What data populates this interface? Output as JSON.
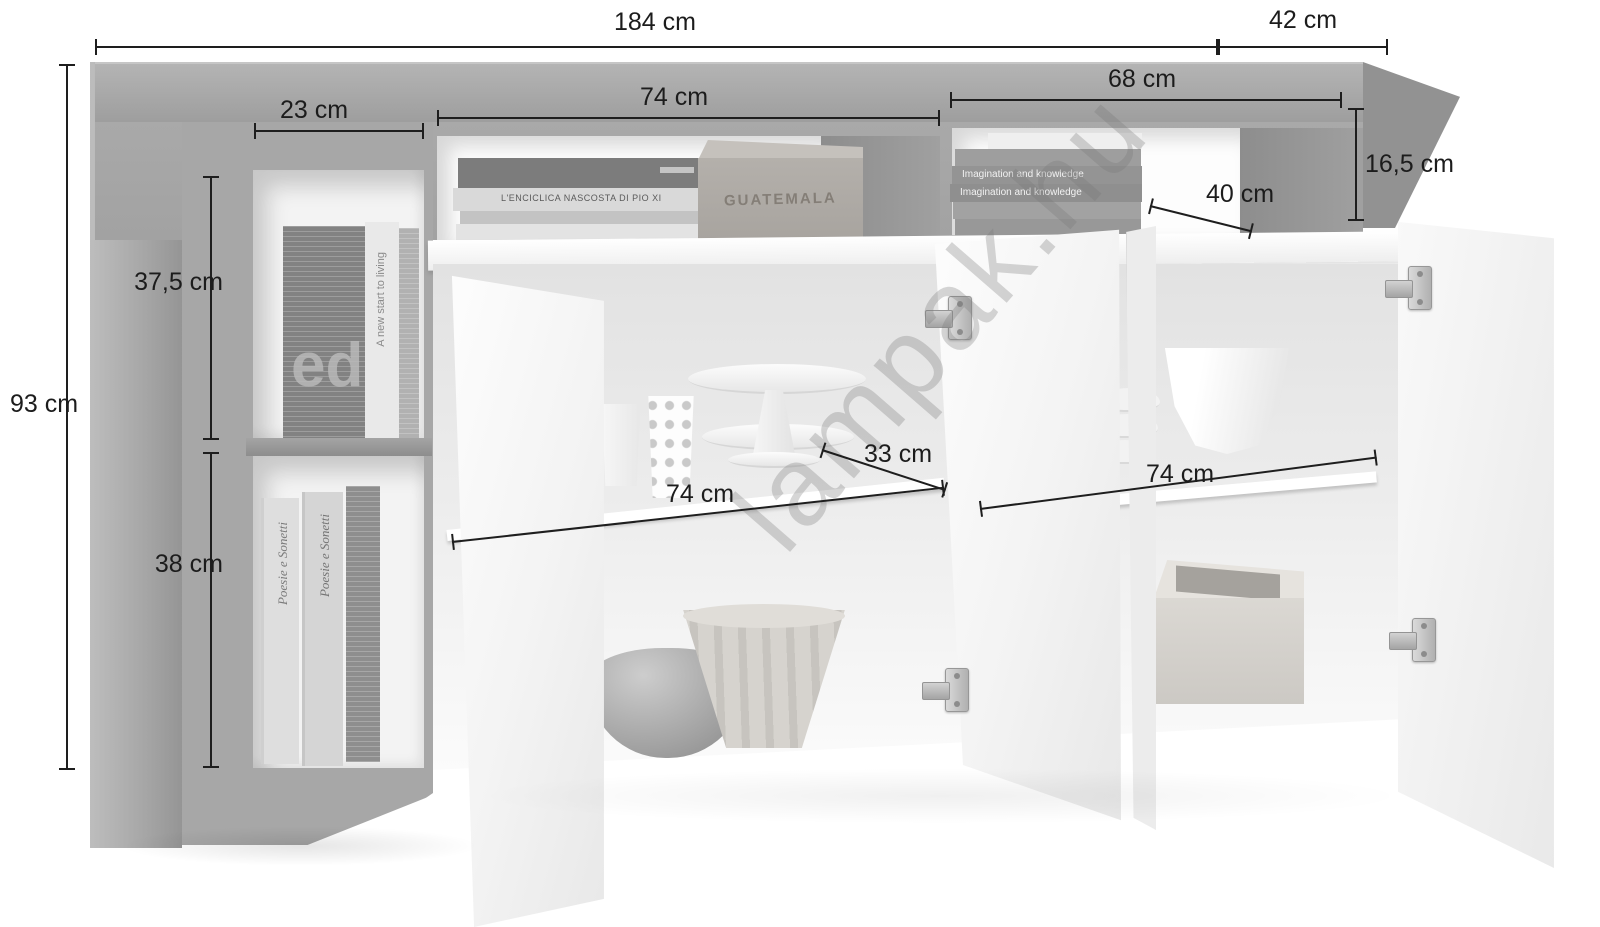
{
  "watermark": "lampak.hu",
  "dimensions": {
    "total_width": "184 cm",
    "depth": "42 cm",
    "height": "93 cm",
    "left_compartment_width": "23 cm",
    "top_middle_niche_width": "74 cm",
    "top_right_niche_width": "68 cm",
    "niche_height": "16,5 cm",
    "niche_depth": "40 cm",
    "upper_shelf_height": "37,5 cm",
    "lower_shelf_height": "38 cm",
    "left_cabinet_width": "74 cm",
    "middle_cabinet_width": "33 cm",
    "right_cabinet_width": "74 cm"
  },
  "props": {
    "crate_text": "GUATEMALA",
    "book_enciclica": "L'ENCICLICA NASCOSTA DI PIO XI",
    "book_imagination": "Imagination and knowledge",
    "book_poesie": "Poesie e Sonetti",
    "book_newstart": "A new start to living",
    "book_ed": "ed"
  },
  "colors": {
    "dimension_line": "#1e1e1e",
    "furniture_gray": "#a8a8a8",
    "door_white": "#f4f4f4"
  }
}
